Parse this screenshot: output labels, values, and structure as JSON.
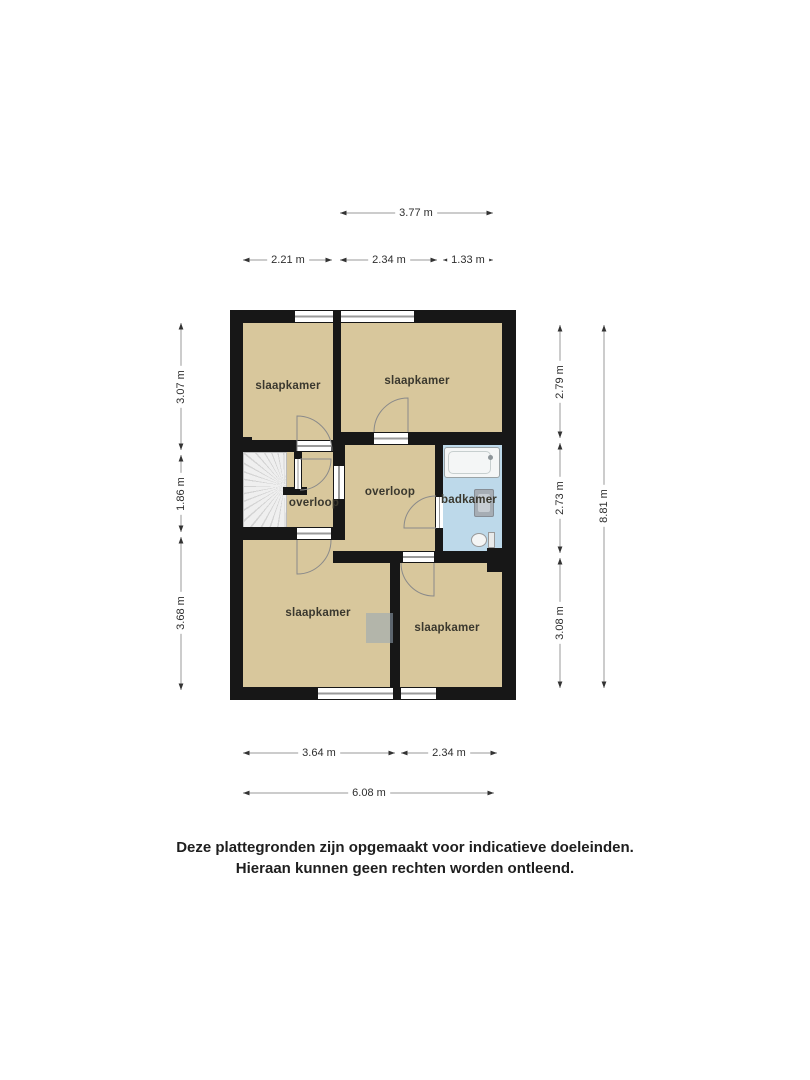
{
  "rooms": {
    "bedroom_tl": "slaapkamer",
    "bedroom_tr": "slaapkamer",
    "bedroom_bl": "slaapkamer",
    "bedroom_br": "slaapkamer",
    "landing_left": "overloop",
    "landing_center": "overloop",
    "bathroom": "badkamer"
  },
  "dimensions": {
    "top_total": "3.77 m",
    "top_left": "2.21 m",
    "top_mid": "2.34 m",
    "top_right": "1.33 m",
    "left_top": "3.07 m",
    "left_mid": "1.86 m",
    "left_bottom": "3.68 m",
    "right_top": "2.79 m",
    "right_mid": "2.73 m",
    "right_bottom": "3.08 m",
    "right_total": "8.81 m",
    "bottom_left": "3.64 m",
    "bottom_right": "2.34 m",
    "bottom_total": "6.08 m"
  },
  "disclaimer": {
    "line1": "Deze plattegronden zijn opgemaakt voor indicatieve doeleinden.",
    "line2": "Hieraan kunnen geen rechten worden ontleend."
  },
  "colors": {
    "floor": "#d8c79c",
    "bathroom_floor": "#bdd9ea",
    "wall": "#171717",
    "dimension_line": "#9a9a9a"
  }
}
